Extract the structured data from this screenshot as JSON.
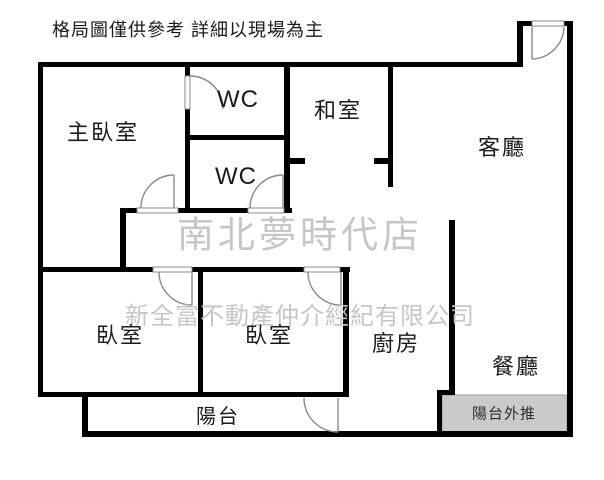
{
  "disclaimer": "格局圖僅供參考 詳細以現場為主",
  "watermarks": {
    "store": "南北夢時代店",
    "company": "新全富不動產仲介經紀有限公司"
  },
  "rooms": {
    "master_bedroom": "主臥室",
    "wc1": "WC",
    "wc2": "WC",
    "tatami_room": "和室",
    "living_room": "客廳",
    "bedroom_left": "臥室",
    "bedroom_right": "臥室",
    "kitchen": "廚房",
    "dining_room": "餐廳",
    "balcony": "陽台",
    "balcony_extension": "陽台外推"
  },
  "colors": {
    "wall": "#000000",
    "background": "#ffffff",
    "watermark": "#c6c6c6",
    "balcony_extension_fill": "#cacaca",
    "door_line": "#8a8a8a"
  }
}
